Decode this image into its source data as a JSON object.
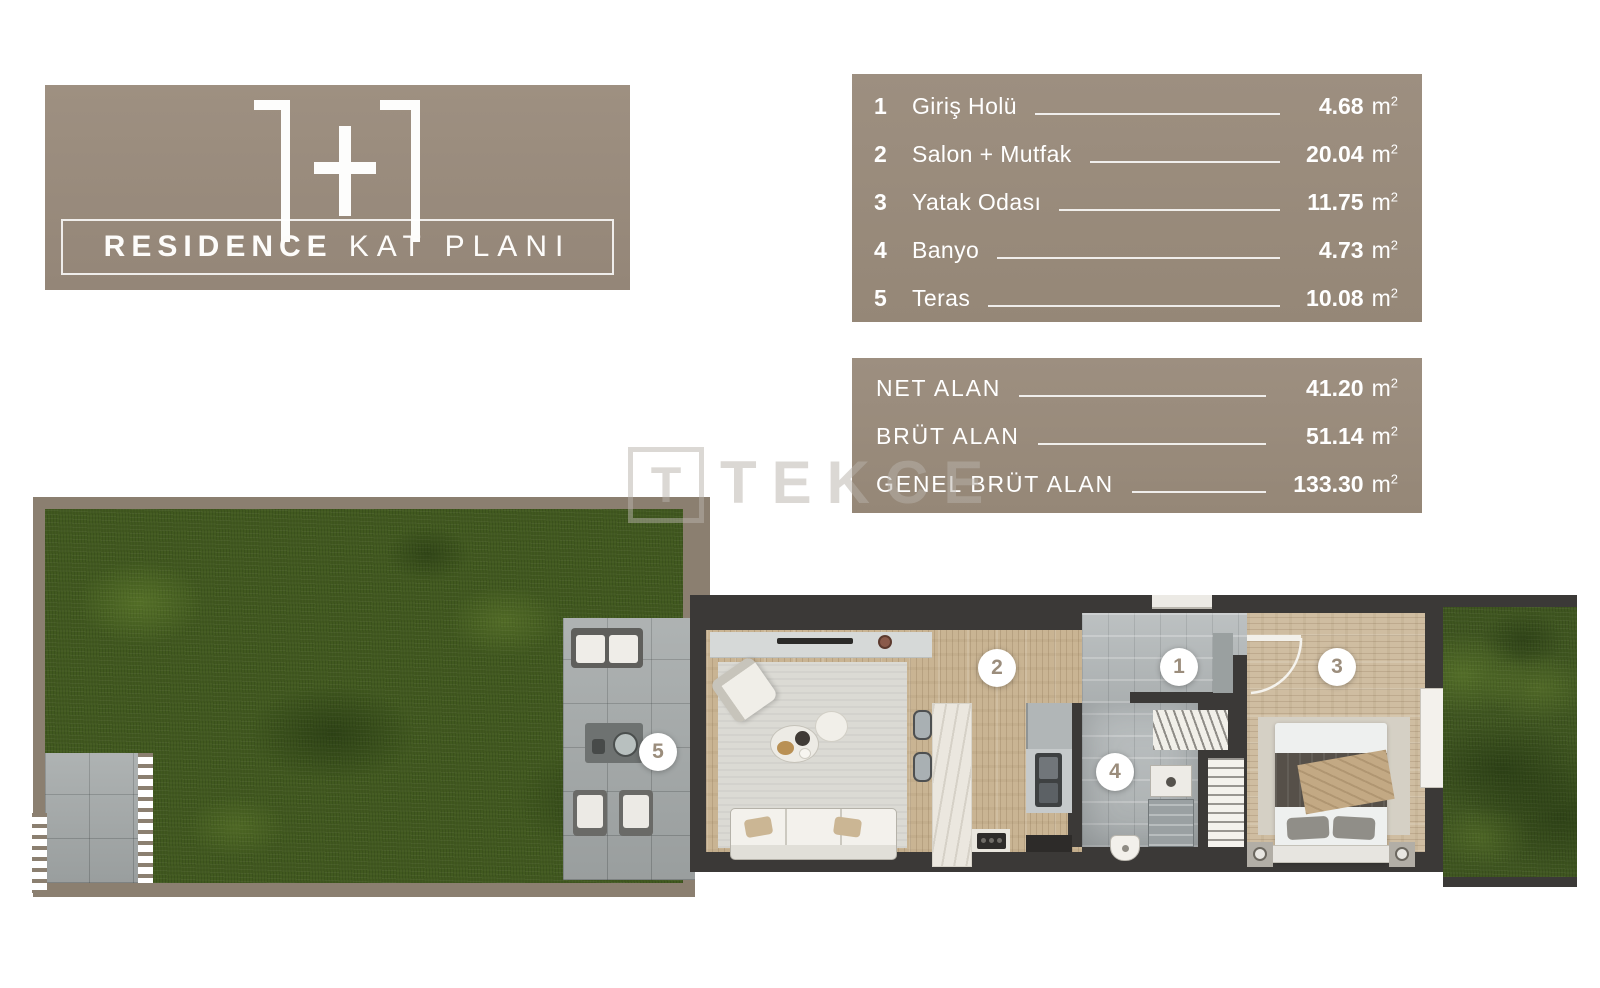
{
  "title_block": {
    "headline": "1+1",
    "label_bold": "RESIDENCE",
    "label_light": "KAT PLANI"
  },
  "rooms_panel": {
    "rows": [
      {
        "num": "1",
        "label": "Giriş Holü",
        "value": "4.68",
        "unit": "m",
        "unit_sup": "2"
      },
      {
        "num": "2",
        "label": "Salon + Mutfak",
        "value": "20.04",
        "unit": "m",
        "unit_sup": "2"
      },
      {
        "num": "3",
        "label": "Yatak Odası",
        "value": "11.75",
        "unit": "m",
        "unit_sup": "2"
      },
      {
        "num": "4",
        "label": "Banyo",
        "value": "4.73",
        "unit": "m",
        "unit_sup": "2"
      },
      {
        "num": "5",
        "label": "Teras",
        "value": "10.08",
        "unit": "m",
        "unit_sup": "2"
      }
    ]
  },
  "areas_panel": {
    "rows": [
      {
        "label": "NET ALAN",
        "value": "41.20",
        "unit": "m",
        "unit_sup": "2"
      },
      {
        "label": "BRÜT ALAN",
        "value": "51.14",
        "unit": "m",
        "unit_sup": "2"
      },
      {
        "label": "GENEL BRÜT ALAN",
        "value": "133.30",
        "unit": "m",
        "unit_sup": "2"
      }
    ]
  },
  "watermark": {
    "logo_letter": "T",
    "brand": "TEKCE"
  },
  "floorplan": {
    "markers": [
      {
        "label": "1"
      },
      {
        "label": "2"
      },
      {
        "label": "3"
      },
      {
        "label": "4"
      },
      {
        "label": "5"
      }
    ]
  },
  "colors": {
    "panel_taupe": "#998a7b",
    "garden_wall": "#8b7f70",
    "unit_wall": "#3b3937",
    "grass": "#41591f",
    "text_white": "#ffffff",
    "marker_text": "#9b8d7c"
  }
}
